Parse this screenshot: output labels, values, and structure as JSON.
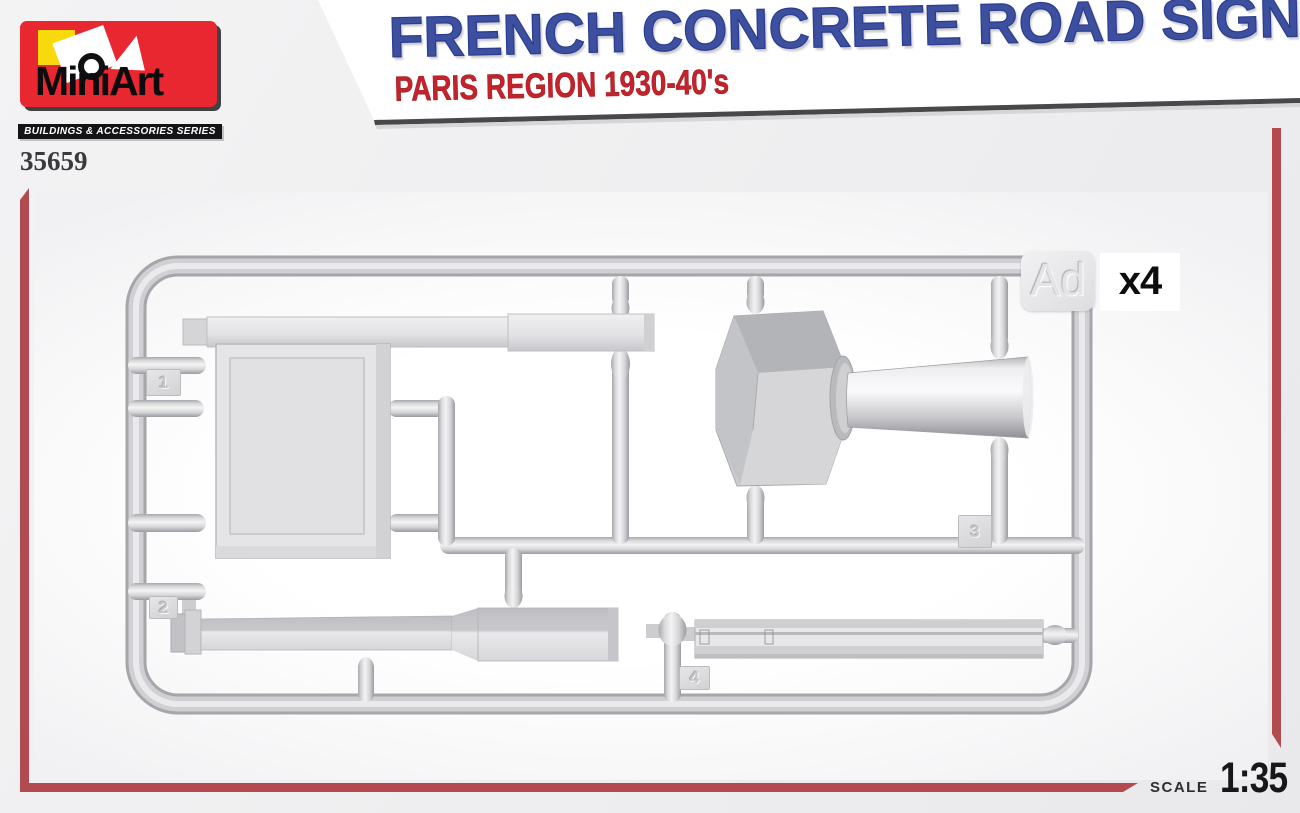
{
  "brand": {
    "name": "MiniArt",
    "series": "BUILDINGS & ACCESSORIES SERIES",
    "product_code": "35659",
    "logo_red": "#e92730",
    "logo_yellow": "#f7d90c"
  },
  "title": {
    "main": "FRENCH CONCRETE ROAD SIGNS",
    "sub": "PARIS REGION 1930-40's",
    "main_color": "#3d50a0",
    "sub_color": "#c3242c"
  },
  "sprue": {
    "label": "Ad",
    "quantity": "x4",
    "parts": [
      {
        "number": "1"
      },
      {
        "number": "2"
      },
      {
        "number": "3"
      },
      {
        "number": "4"
      }
    ]
  },
  "footer": {
    "scale_label": "SCALE",
    "scale_value": "1:35"
  },
  "colors": {
    "accent_red": "#b14b4f",
    "plastic_gray": "#d3d3d6",
    "background": "#f0f0f1"
  }
}
